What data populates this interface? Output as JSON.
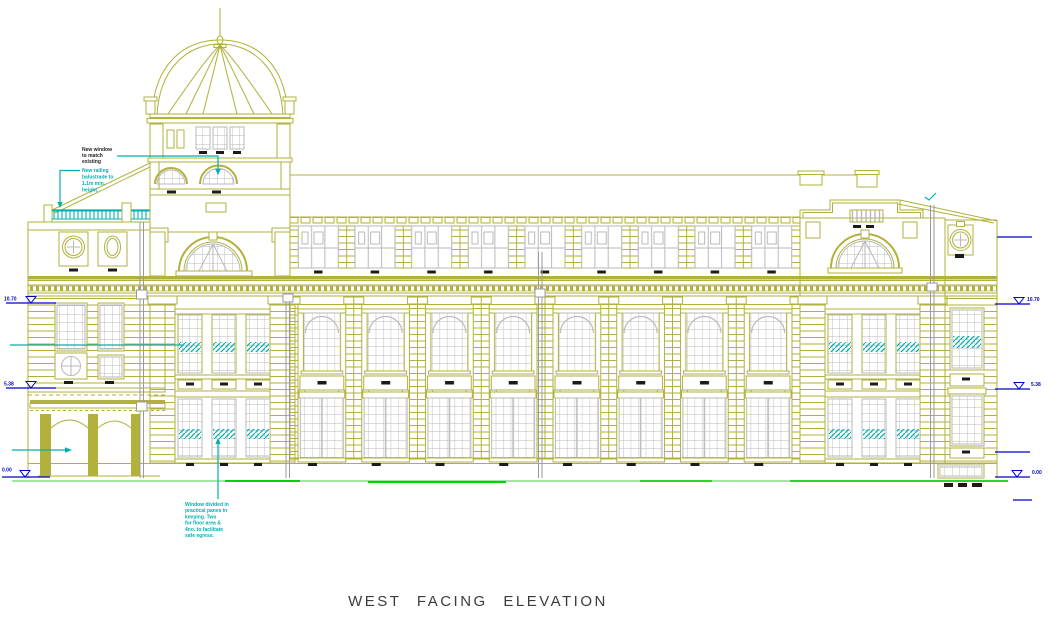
{
  "title": {
    "text": "WEST FACING ELEVATION"
  },
  "annotations": {
    "new_window": {
      "lines": [
        "New window",
        "to match",
        "existing"
      ]
    },
    "new_railing": {
      "lines": [
        "New railing",
        "balustrade to",
        "1.1m min.",
        "height."
      ]
    },
    "window_note": {
      "lines": [
        "Window divided in",
        "practical panes in",
        "keeping. Two",
        "for floor area &",
        "4no. to facilitate",
        "safe egress."
      ]
    }
  },
  "levels": {
    "left": [
      {
        "value": "10.70"
      },
      {
        "value": "5.38"
      },
      {
        "value": "0.00"
      }
    ],
    "right": [
      {
        "value": "10.70"
      },
      {
        "value": "5.38"
      },
      {
        "value": "0.00"
      }
    ]
  },
  "colors": {
    "olive": "#b1b13b",
    "glaze": "#b9b9b9",
    "cyan": "#00b0b2",
    "blue": "#0000cd",
    "green_light": "#a3e6a3",
    "green_bright": "#00d400",
    "ink": "#1b1b1b",
    "title": "#3c3c3c",
    "pipe": "#9a9a9a"
  }
}
